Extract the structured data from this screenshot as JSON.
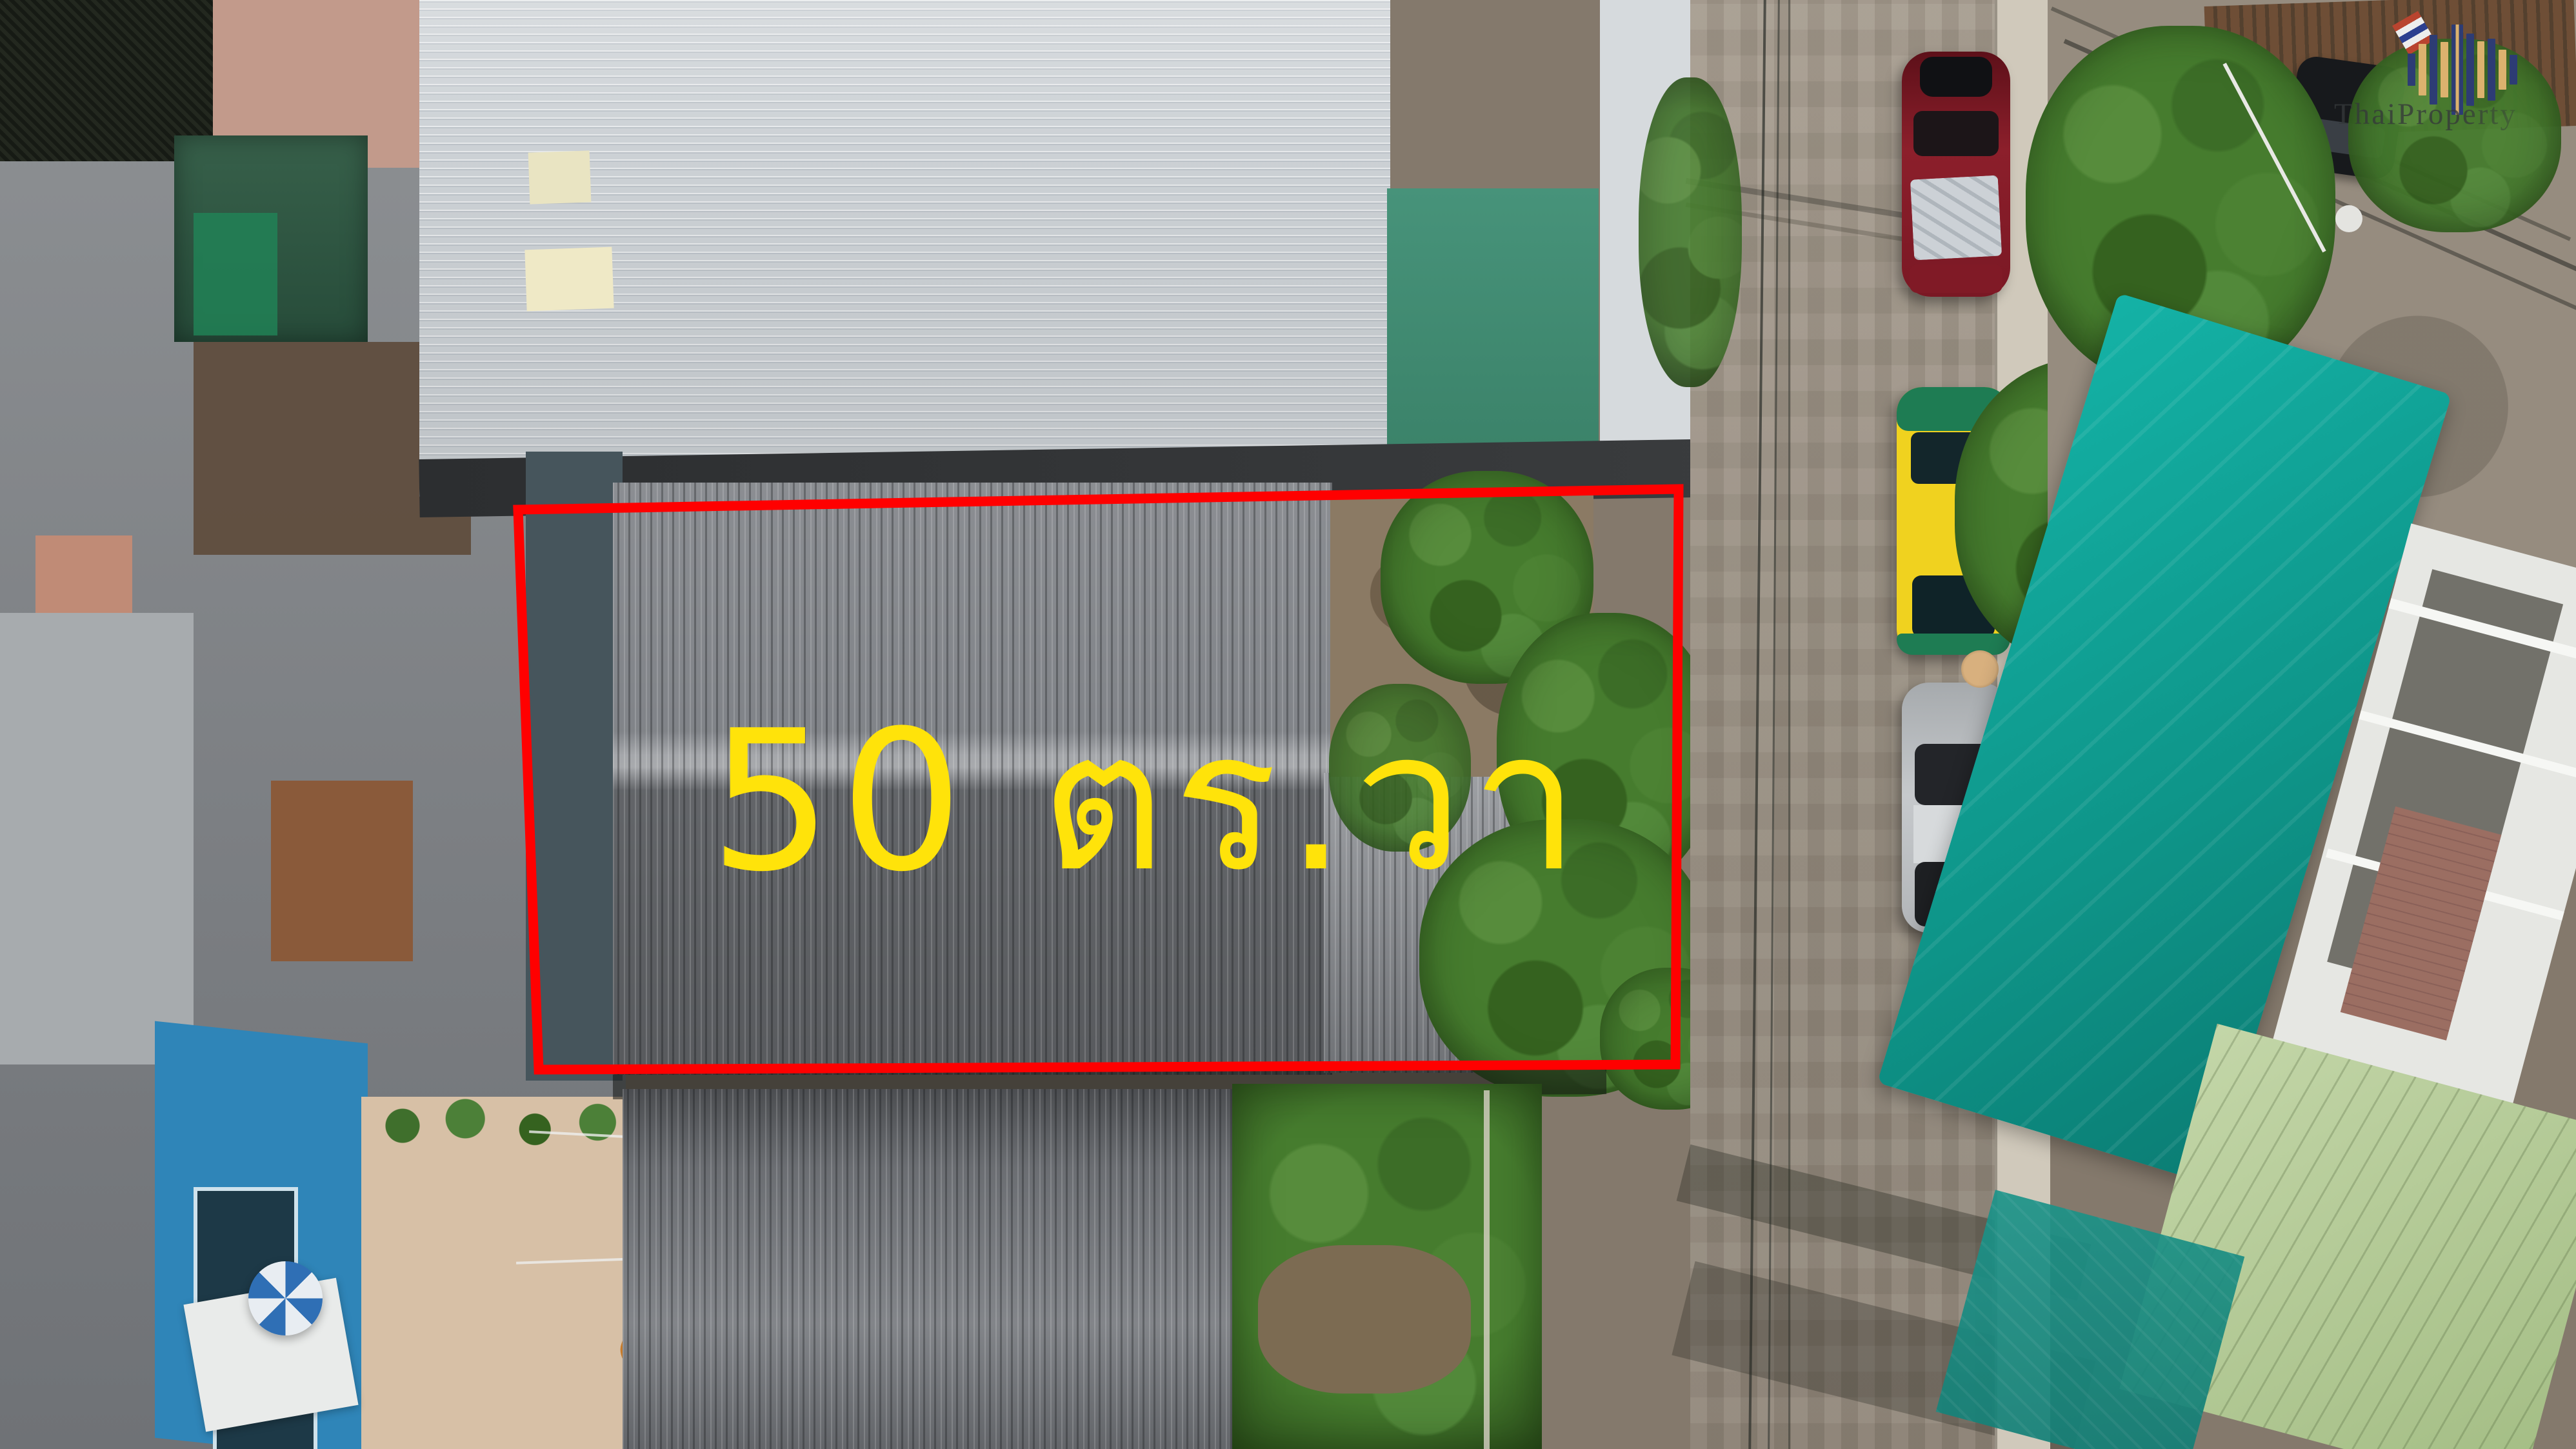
{
  "annotation": {
    "area_label": "50 ตร.วา",
    "area_label_color": "#ffe30a",
    "boundary_color": "#ff0000"
  },
  "watermark": {
    "text": "ThaiProperty",
    "logo_icon": "skyline-bars-logo",
    "logo_navy": "#2d3c74",
    "logo_gold": "#dcb26e"
  },
  "palette": {
    "taxi_yellow": "#f0d21f",
    "taxi_green": "#1e7c53",
    "red_car": "#7c1420",
    "silver_car": "#bcbfc2",
    "teal_tarp": "#12b0a3",
    "pale_green_roof": "#b5cb97",
    "blue_house": "#2f85b8"
  }
}
